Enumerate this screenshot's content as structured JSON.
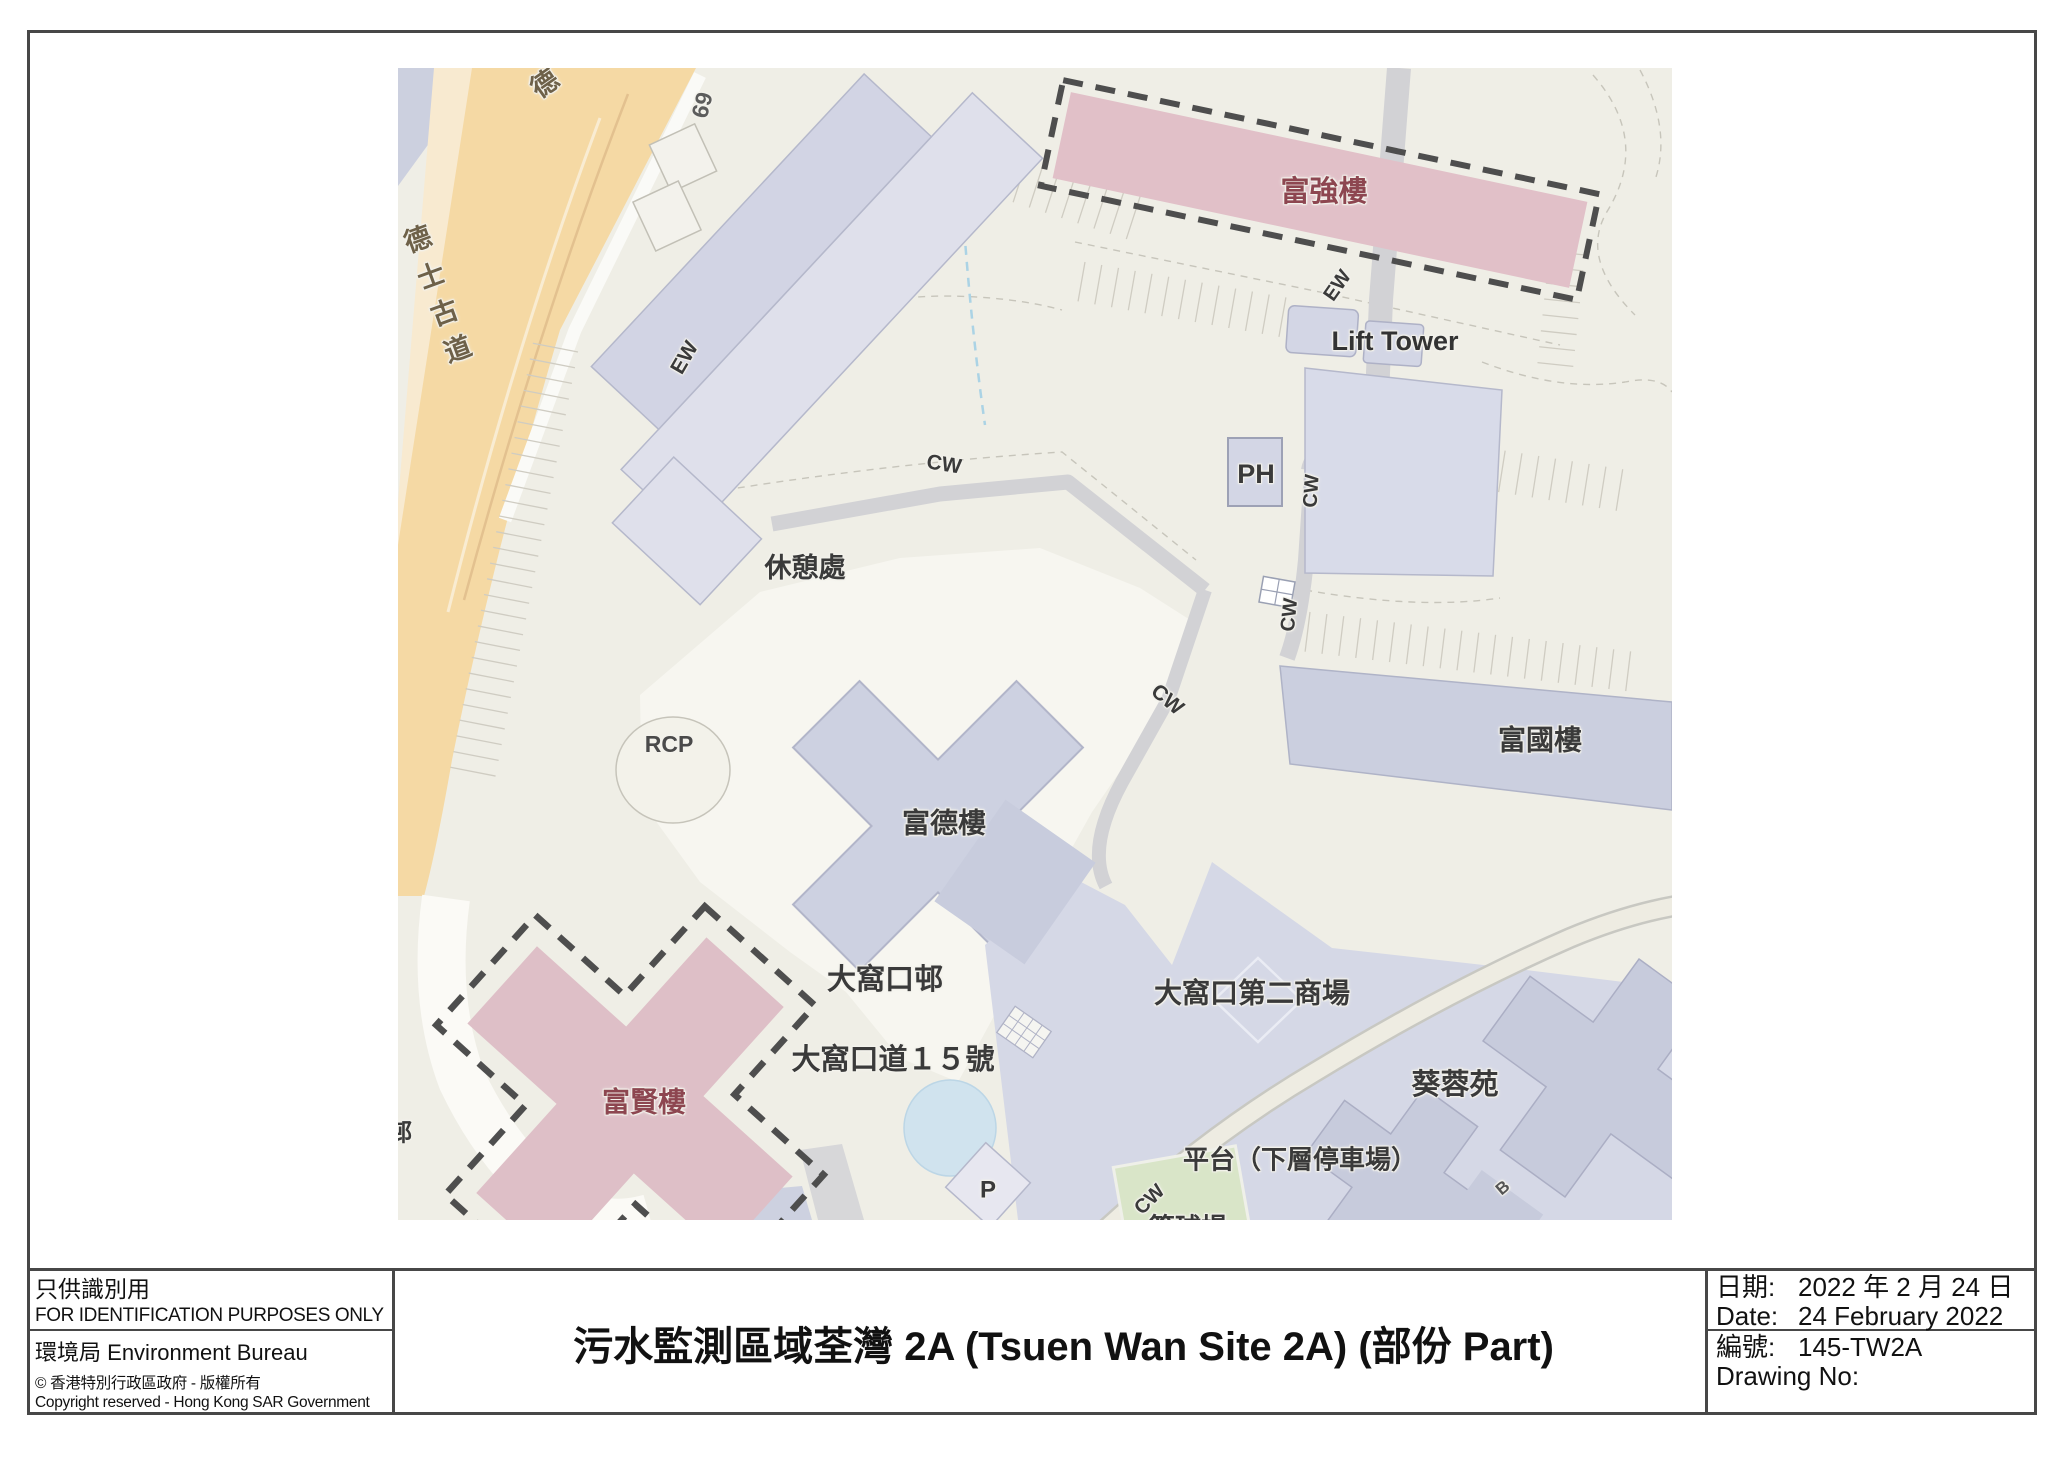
{
  "map": {
    "colors": {
      "background": "#efeee6",
      "building": "#cdd1e1",
      "building_light": "#dfe0eb",
      "highlight_fill": "#debfc7",
      "highlight_label_color": "#8d4650",
      "road_orange": "#f5d9a4",
      "walkway_gray": "#d2d2d5",
      "green_court": "#d9e5c8",
      "pond_blue": "#d0e3ee",
      "dashed_outline": "#4e4e4e"
    },
    "labels": [
      {
        "id": "texaco-road",
        "text": "德士古道",
        "x": 437,
        "y": 300,
        "rot": -20,
        "size": 27,
        "color": "#6e6149",
        "vertical": true
      },
      {
        "id": "texaco-road-top",
        "text": "德",
        "x": 545,
        "y": 84,
        "rot": -35,
        "size": 27,
        "color": "#6e6149"
      },
      {
        "id": "lot-69",
        "text": "69",
        "x": 702,
        "y": 105,
        "rot": -76,
        "size": 23,
        "color": "#5c5c5c"
      },
      {
        "id": "ew-1",
        "text": "EW",
        "x": 685,
        "y": 358,
        "rot": -60,
        "size": 21
      },
      {
        "id": "ew-2",
        "text": "EW",
        "x": 1338,
        "y": 286,
        "rot": -55,
        "size": 20
      },
      {
        "id": "lift-tower",
        "text": "Lift Tower",
        "x": 1395,
        "y": 341,
        "rot": 0,
        "size": 27,
        "color": "#333333"
      },
      {
        "id": "ph",
        "text": "PH",
        "x": 1256,
        "y": 474,
        "rot": 0,
        "size": 27
      },
      {
        "id": "cw-1",
        "text": "CW",
        "x": 944,
        "y": 465,
        "rot": 9,
        "size": 21
      },
      {
        "id": "cw-2",
        "text": "CW",
        "x": 1312,
        "y": 491,
        "rot": -86,
        "size": 20
      },
      {
        "id": "cw-3",
        "text": "CW",
        "x": 1290,
        "y": 615,
        "rot": -84,
        "size": 20
      },
      {
        "id": "cw-4",
        "text": "CW",
        "x": 1167,
        "y": 700,
        "rot": 40,
        "size": 21
      },
      {
        "id": "rest-garden",
        "text": "休憩處",
        "x": 805,
        "y": 568,
        "rot": 0,
        "size": 27
      },
      {
        "id": "rcp",
        "text": "RCP",
        "x": 669,
        "y": 744,
        "rot": 0,
        "size": 23,
        "color": "#4a4a4a"
      },
      {
        "id": "fu-tak-house",
        "text": "富德樓",
        "x": 944,
        "y": 823,
        "rot": 0,
        "size": 28
      },
      {
        "id": "fu-kwok-house",
        "text": "富國樓",
        "x": 1540,
        "y": 740,
        "rot": 0,
        "size": 28
      },
      {
        "id": "tai-wo-hau-estate",
        "text": "大窩口邨",
        "x": 885,
        "y": 980,
        "rot": 0,
        "size": 29
      },
      {
        "id": "address-15",
        "text": "大窩口道１５號",
        "x": 893,
        "y": 1060,
        "rot": 0,
        "size": 29
      },
      {
        "id": "fu-yin-house",
        "text": "富賢樓",
        "x": 644,
        "y": 1102,
        "rot": 0,
        "size": 28,
        "color": "#8d4650"
      },
      {
        "id": "p-mark",
        "text": "P",
        "x": 988,
        "y": 1190,
        "rot": 0,
        "size": 24
      },
      {
        "id": "second-mall",
        "text": "大窩口第二商場",
        "x": 1252,
        "y": 993,
        "rot": 0,
        "size": 28
      },
      {
        "id": "kwai-yung-court",
        "text": "葵蓉苑",
        "x": 1455,
        "y": 1085,
        "rot": 0,
        "size": 29
      },
      {
        "id": "platform-carpark",
        "text": "平台（下層停車場）",
        "x": 1300,
        "y": 1160,
        "rot": 0,
        "size": 26
      },
      {
        "id": "cw-5",
        "text": "CW",
        "x": 1150,
        "y": 1200,
        "rot": -45,
        "size": 20
      },
      {
        "id": "basketball-court",
        "text": "籃球場",
        "x": 1188,
        "y": 1228,
        "rot": 0,
        "size": 26
      },
      {
        "id": "b-mark",
        "text": "B",
        "x": 1503,
        "y": 1188,
        "rot": -40,
        "size": 17,
        "color": "#555555"
      },
      {
        "id": "estate-partial",
        "text": "邨",
        "x": 400,
        "y": 1133,
        "rot": 0,
        "size": 24
      },
      {
        "id": "fu-keung-house",
        "text": "富強樓",
        "x": 1324,
        "y": 192,
        "rot": 0,
        "size": 29,
        "color": "#8d4650"
      }
    ]
  },
  "footer": {
    "left": {
      "id_zh": "只供識別用",
      "id_en": "FOR IDENTIFICATION PURPOSES ONLY",
      "bureau_zh": "環境局",
      "bureau_en": "Environment Bureau",
      "copyright_zh": "© 香港特別行政區政府 - 版權所有",
      "copyright_en": "Copyright reserved - Hong Kong SAR Government"
    },
    "title": "污水監測區域荃灣 2A (Tsuen Wan Site 2A) (部份 Part)",
    "right": {
      "date_label_zh": "日期:",
      "date_value_zh": "2022 年 2 月 24 日",
      "date_label_en": "Date:",
      "date_value_en": "24 February 2022",
      "no_label_zh": "編號:",
      "no_value": "145-TW2A",
      "no_label_en": "Drawing No:"
    }
  }
}
